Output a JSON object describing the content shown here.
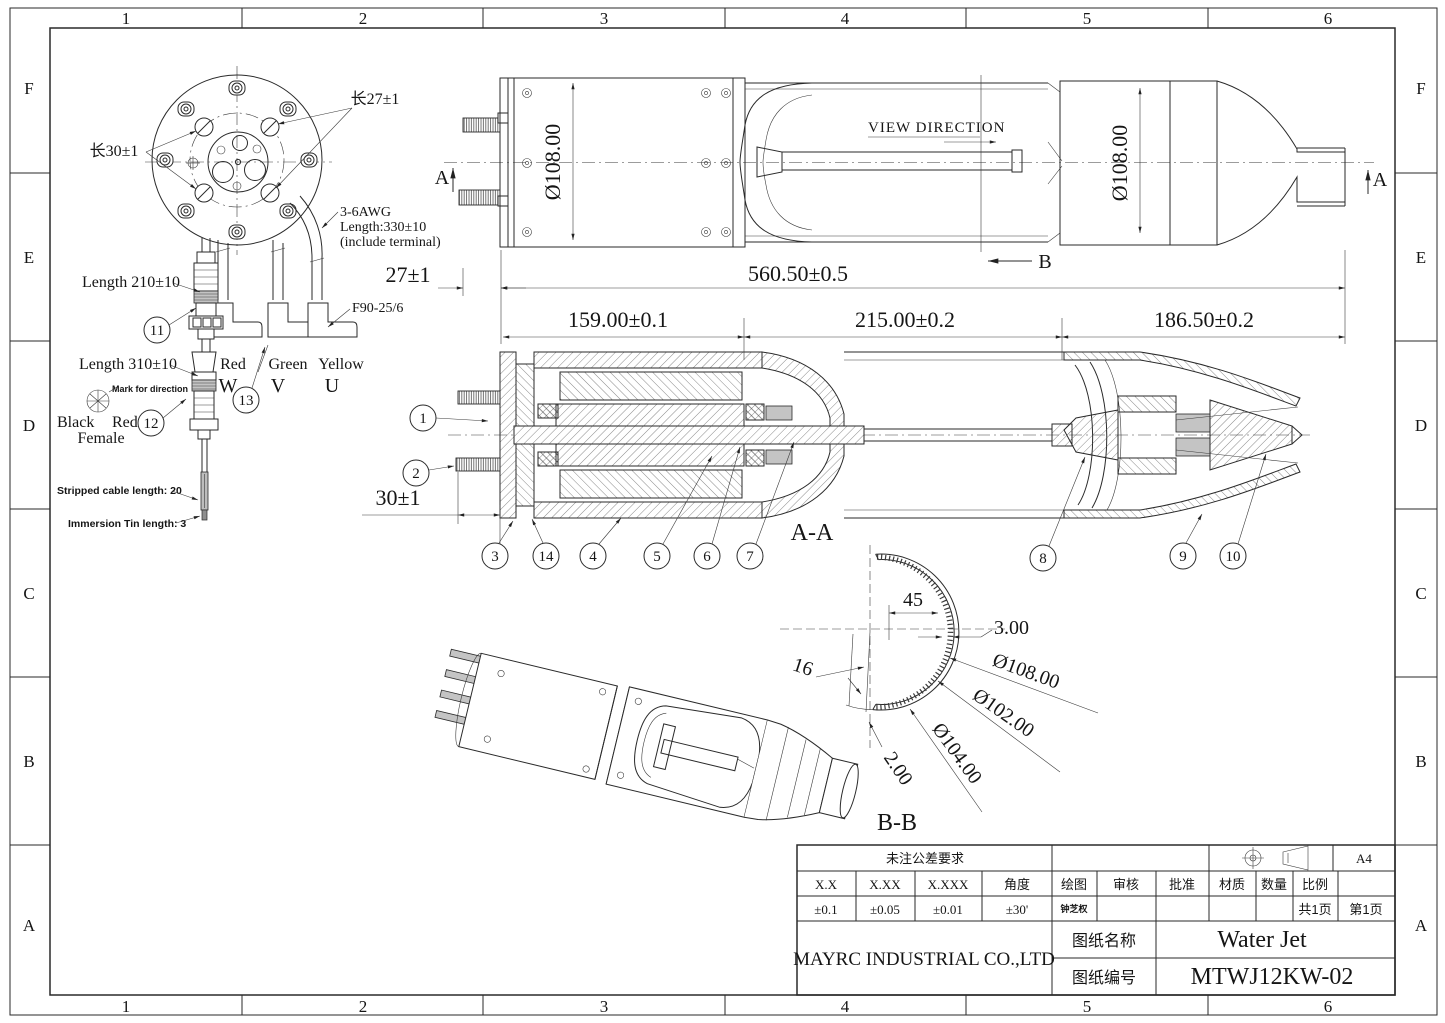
{
  "frame": {
    "cols": [
      "1",
      "2",
      "3",
      "4",
      "5",
      "6"
    ],
    "rows": [
      "F",
      "E",
      "D",
      "C",
      "B",
      "A"
    ]
  },
  "colors": {
    "ink": "#2a2a2a",
    "shade": "#c4c4c4",
    "paper": "#ffffff"
  },
  "connector_view": {
    "len27": "长27±1",
    "len30": "长30±1",
    "awg1": "3-6AWG",
    "awg2": "Length:330±10",
    "awg3": "(include terminal)",
    "length210": "Length 210±10",
    "f90": "F90-25/6",
    "length310": "Length 310±10",
    "mark": "Mark for direction",
    "black": "Black",
    "red": "Red",
    "female": "Female",
    "stripped": "Stripped cable length: 20",
    "immersion": "Immersion Tin length: 3",
    "wire_red": "Red",
    "wire_green": "Green",
    "wire_yellow": "Yellow",
    "phase_w": "W",
    "phase_v": "V",
    "phase_u": "U"
  },
  "top_view": {
    "view_direction": "VIEW DIRECTION",
    "dia_left": "Ø108.00",
    "dia_right": "Ø108.00",
    "a_left": "A",
    "a_right": "A",
    "b_mark": "B"
  },
  "dims": {
    "d27": "27±1",
    "d560": "560.50±0.5",
    "d159": "159.00±0.1",
    "d215": "215.00±0.2",
    "d186": "186.50±0.2",
    "d30": "30±1"
  },
  "aa": {
    "label": "A-A"
  },
  "bb": {
    "label": "B-B",
    "d45": "45",
    "d3": "3.00",
    "d108": "Ø108.00",
    "d102": "Ø102.00",
    "d104": "Ø104.00",
    "d2": "2.00",
    "d16": "16"
  },
  "balloons": {
    "b1": "1",
    "b2": "2",
    "b3": "3",
    "b4": "4",
    "b5": "5",
    "b6": "6",
    "b7": "7",
    "b8": "8",
    "b9": "9",
    "b10": "10",
    "b11": "11",
    "b12": "12",
    "b13": "13",
    "b14": "14"
  },
  "title_block": {
    "tol_header": "未注公差要求",
    "c_xx": "X.X",
    "c_xxx": "X.XX",
    "c_xxxx": "X.XXX",
    "c_angle": "角度",
    "v_xx": "±0.1",
    "v_xxx": "±0.05",
    "v_xxxx": "±0.01",
    "v_angle": "±30'",
    "draw": "绘图",
    "check": "审核",
    "approve": "批准",
    "material": "材质",
    "qty": "数量",
    "scale": "比例",
    "drawer": "钟芝权",
    "pages_total": "共1页",
    "page_no": "第1页",
    "sheet_size": "A4",
    "company": "MAYRC INDUSTRIAL CO.,LTD",
    "name_label": "图纸名称",
    "name_value": "Water Jet",
    "no_label": "图纸编号",
    "no_value": "MTWJ12KW-02"
  }
}
